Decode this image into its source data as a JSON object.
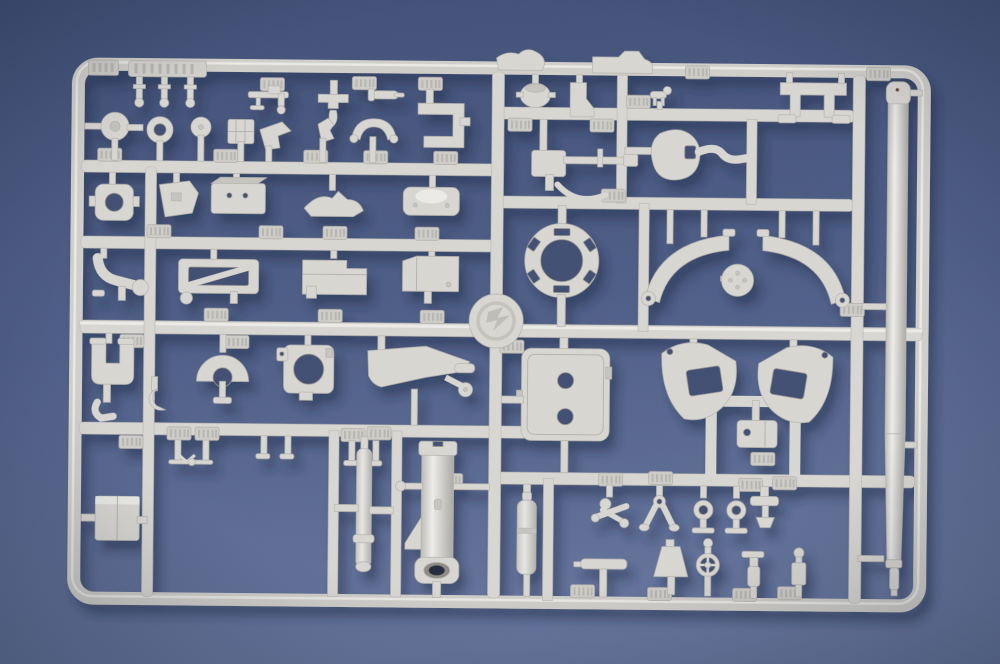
{
  "meta": {
    "description": "Photograph of a light-grey injection-molded plastic model kit sprue (parts tree) lying on a blue backdrop",
    "no_visible_text": "embossed part-number tags on the sprue are present but illegible at this resolution"
  },
  "colors": {
    "background_top": "#3e4d75",
    "background_mid": "#4a5a83",
    "background_bottom": "#64739b",
    "plastic": "#d7d5d0",
    "plastic_highlight": "#ecebe8",
    "plastic_shadow": "#a9a7a2",
    "plastic_edge": "#b3b1ac",
    "hole_dark": "#3d4b70",
    "cast_shadow": "#1c2947"
  },
  "sprue": {
    "frame": "rounded rectangular outer runner frame",
    "center_emblem": "round molded logo disc at the runner crossing",
    "tag_text": "illegible embossed part-number plates",
    "parts": [
      "ribbed-strip-with-pins",
      "pin-parts",
      "small-gun-part",
      "yoke-part",
      "torpedo-part",
      "c-bracket",
      "wave-part",
      "cap-part",
      "boot-bracket",
      "tiny-part",
      "u-bracket",
      "flange-wheel",
      "ring-part",
      "small-disc",
      "grid-plate",
      "periscope-part",
      "figure-part",
      "saddle-part",
      "flange-with-hole",
      "angular-bracket",
      "box-with-holes",
      "wing-part",
      "rounded-plate",
      "curved-clamp",
      "open-frame-part",
      "large-box",
      "beveled-box",
      "machine-gun-part",
      "ball-crank-part",
      "turret-ring",
      "arc-part-left",
      "arc-part-right",
      "dimpled-disc",
      "claw-clamp",
      "fan-part",
      "plate-with-hole",
      "gun-cradle",
      "hatch-plate",
      "trail-leg-left",
      "trail-leg-right",
      "block-with-hole",
      "pin-pair",
      "side-box",
      "shaft-part",
      "mortar-tube",
      "small-cylinder",
      "linkage-cluster",
      "y-legs-part",
      "ring-lollipop",
      "t-bar-part",
      "lamp-shade-part",
      "spoked-wheel-part",
      "step-finial",
      "t-bolt-part",
      "ball-head-part",
      "gun-barrel"
    ]
  }
}
